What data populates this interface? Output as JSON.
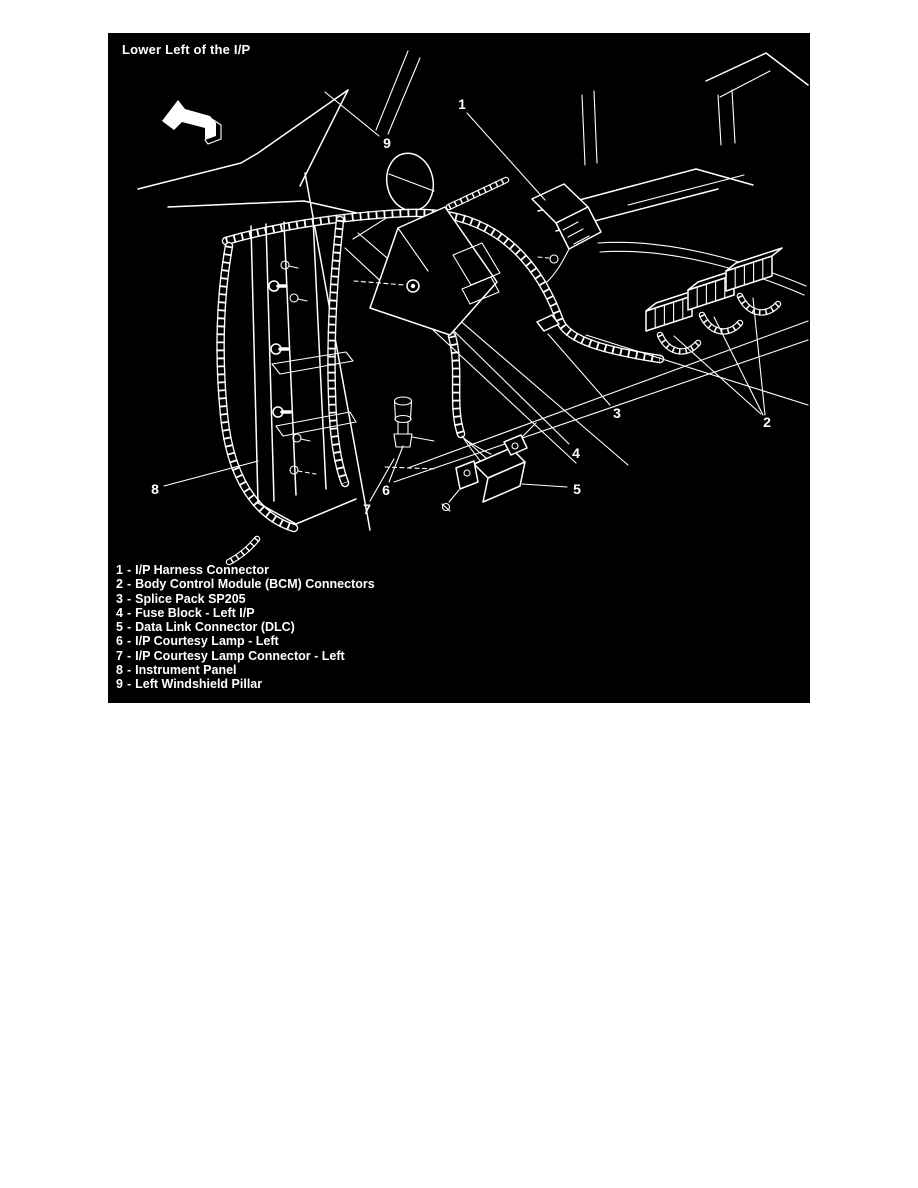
{
  "figure": {
    "title": "Lower Left of the I/P",
    "colors": {
      "page_background": "#ffffff",
      "figure_background": "#000000",
      "line": "#ffffff",
      "text": "#ffffff"
    }
  },
  "diagram": {
    "direction_arrow_icon": "up-left-arrow",
    "callout_labels": [
      "1",
      "2",
      "3",
      "4",
      "5",
      "6",
      "7",
      "8",
      "9"
    ]
  },
  "legend": {
    "separator": "-",
    "items": [
      {
        "num": "1",
        "label": "I/P Harness Connector"
      },
      {
        "num": "2",
        "label": "Body Control Module (BCM) Connectors"
      },
      {
        "num": "3",
        "label": "Splice Pack SP205"
      },
      {
        "num": "4",
        "label": "Fuse Block - Left I/P"
      },
      {
        "num": "5",
        "label": "Data Link Connector (DLC)"
      },
      {
        "num": "6",
        "label": "I/P Courtesy Lamp - Left"
      },
      {
        "num": "7",
        "label": "I/P Courtesy Lamp Connector - Left"
      },
      {
        "num": "8",
        "label": "Instrument Panel"
      },
      {
        "num": "9",
        "label": "Left Windshield Pillar"
      }
    ]
  }
}
